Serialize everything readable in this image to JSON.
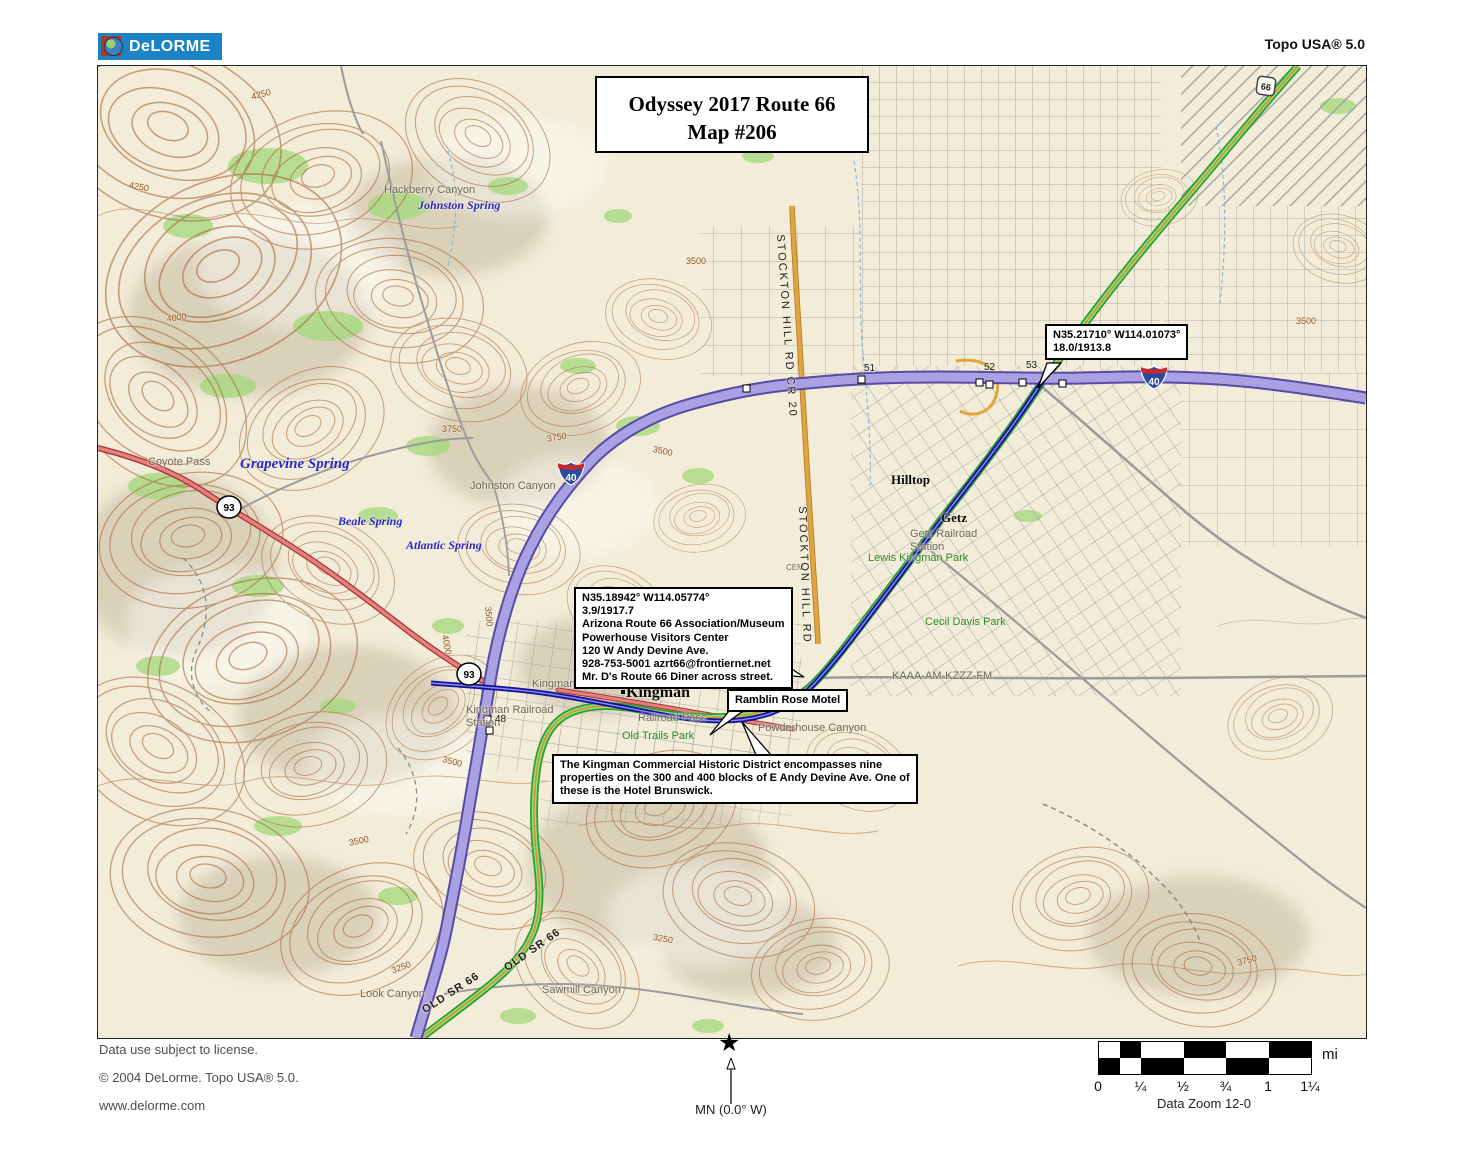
{
  "header": {
    "logo": "DeLORME",
    "product": "Topo USA® 5.0"
  },
  "map": {
    "title_box": {
      "line1": "Odyssey 2017 Route 66",
      "line2": "Map #206"
    },
    "callouts": {
      "waypoint": "N35.21710° W114.01073°\n18.0/1913.8",
      "powerhouse": "N35.18942° W114.05774°\n3.9/1917.7\nArizona Route 66 Association/Museum\nPowerhouse Visitors Center\n120 W Andy Devine Ave.\n928-753-5001 azrt66@frontiernet.net\nMr. D's Route 66 Diner across street.",
      "motel": "Ramblin Rose Motel",
      "historic": "The Kingman Commercial Historic District encompasses nine properties on the 300 and 400 blocks of E Andy Devine Ave. One of these is the Hotel Brunswick."
    },
    "shields": {
      "interstate_40": "40",
      "us_93": "93",
      "historic_66": "66"
    },
    "labels": [
      {
        "text": "Hackberry Canyon",
        "x": 286,
        "y": 118,
        "cls": "terr"
      },
      {
        "text": "Johnston Spring",
        "x": 320,
        "y": 132,
        "cls": "spring"
      },
      {
        "text": "Coyote Pass",
        "x": 50,
        "y": 390,
        "cls": "terr"
      },
      {
        "text": "Grapevine Spring",
        "x": 142,
        "y": 390,
        "cls": "spring big"
      },
      {
        "text": "Beale Spring",
        "x": 240,
        "y": 448,
        "cls": "spring"
      },
      {
        "text": "Atlantic Spring",
        "x": 308,
        "y": 472,
        "cls": "spring"
      },
      {
        "text": "Johnston Canyon",
        "x": 372,
        "y": 414,
        "cls": "terr"
      },
      {
        "text": "Hilltop",
        "x": 793,
        "y": 406,
        "cls": "city"
      },
      {
        "text": "Getz",
        "x": 843,
        "y": 444,
        "cls": "city"
      },
      {
        "text": "Getz Railroad\nStation",
        "x": 812,
        "y": 462,
        "cls": "terr"
      },
      {
        "text": "Lewis Kingman Park",
        "x": 770,
        "y": 486,
        "cls": "park"
      },
      {
        "text": "Cecil Davis Park",
        "x": 827,
        "y": 550,
        "cls": "park"
      },
      {
        "text": "KAAA-AM-KZZZ-FM",
        "x": 794,
        "y": 604,
        "cls": "terr"
      },
      {
        "text": "Kingman",
        "x": 528,
        "y": 618,
        "cls": "city big"
      },
      {
        "text": "Kingman City Hall",
        "x": 434,
        "y": 612,
        "cls": "terr"
      },
      {
        "text": "Kingman Railroad\nStation",
        "x": 368,
        "y": 638,
        "cls": "terr"
      },
      {
        "text": "Railroad Pass",
        "x": 540,
        "y": 646,
        "cls": "terr"
      },
      {
        "text": "Old Trails Park",
        "x": 524,
        "y": 664,
        "cls": "park"
      },
      {
        "text": "Powderhouse Canyon",
        "x": 660,
        "y": 656,
        "cls": "terr"
      },
      {
        "text": "Sawmill Canyon",
        "x": 444,
        "y": 918,
        "cls": "terr"
      },
      {
        "text": "Look Canyon",
        "x": 262,
        "y": 922,
        "cls": "terr"
      },
      {
        "text": "CEM",
        "x": 688,
        "y": 497,
        "cls": "terr small"
      },
      {
        "text": "OLD SR 66",
        "x": 322,
        "y": 940,
        "cls": "road",
        "rot": -33
      },
      {
        "text": "OLD SR 66",
        "x": 404,
        "y": 898,
        "cls": "road",
        "rot": -35
      },
      {
        "text": "STOCKTON HILL RD  CR 20",
        "x": 688,
        "y": 168,
        "cls": "roadv",
        "rot": 86
      },
      {
        "text": "STOCKTON HILL RD",
        "x": 710,
        "y": 440,
        "cls": "roadv",
        "rot": 88
      },
      {
        "text": "51",
        "x": 766,
        "y": 297,
        "cls": "exit"
      },
      {
        "text": "52",
        "x": 886,
        "y": 296,
        "cls": "exit"
      },
      {
        "text": "53",
        "x": 928,
        "y": 294,
        "cls": "exit"
      },
      {
        "text": "48",
        "x": 397,
        "y": 648,
        "cls": "exit"
      },
      {
        "text": "4250",
        "x": 152,
        "y": 26,
        "cls": "elev",
        "rot": -15
      },
      {
        "text": "4250",
        "x": 32,
        "y": 114,
        "cls": "elev",
        "rot": 10
      },
      {
        "text": "4000",
        "x": 68,
        "y": 248,
        "cls": "elev",
        "rot": -8
      },
      {
        "text": "4000",
        "x": 352,
        "y": 568,
        "cls": "elev",
        "rot": 80
      },
      {
        "text": "3750",
        "x": 344,
        "y": 358,
        "cls": "elev"
      },
      {
        "text": "3750",
        "x": 448,
        "y": 368,
        "cls": "elev",
        "rot": -10
      },
      {
        "text": "3500",
        "x": 588,
        "y": 190,
        "cls": "elev"
      },
      {
        "text": "3500",
        "x": 556,
        "y": 378,
        "cls": "elev",
        "rot": 12
      },
      {
        "text": "3500",
        "x": 1198,
        "y": 250,
        "cls": "elev"
      },
      {
        "text": "3500",
        "x": 592,
        "y": 610,
        "cls": "elev",
        "rot": -8
      },
      {
        "text": "3500",
        "x": 346,
        "y": 688,
        "cls": "elev",
        "rot": 15
      },
      {
        "text": "3500",
        "x": 250,
        "y": 772,
        "cls": "elev",
        "rot": -12
      },
      {
        "text": "3250",
        "x": 556,
        "y": 866,
        "cls": "elev",
        "rot": 10
      },
      {
        "text": "3250",
        "x": 292,
        "y": 900,
        "cls": "elev",
        "rot": -20
      },
      {
        "text": "3750",
        "x": 1138,
        "y": 892,
        "cls": "elev",
        "rot": -15
      },
      {
        "text": "3500",
        "x": 395,
        "y": 540,
        "cls": "elev",
        "rot": 85
      }
    ]
  },
  "footer": {
    "license": "Data use subject to license.",
    "copyright": "© 2004 DeLorme. Topo USA® 5.0.",
    "website": "www.delorme.com",
    "north_label": "MN (0.0° W)",
    "scale": {
      "unit": "mi",
      "ticks": [
        "0",
        "¼",
        "½",
        "¾",
        "1",
        "1¼"
      ],
      "datazoom": "Data Zoom 12-0"
    }
  },
  "colors": {
    "map_bg": "#f2ecd8",
    "interstate_fill": "#aaa0e4",
    "interstate_edge": "#574ba2",
    "us_highway": "#e38080",
    "route66_green": "#2f9e2f",
    "historic_gold": "#cf9a22",
    "route_line_blue": "#12129b",
    "minor_road_gray": "#9b9b9b",
    "contour_brown": "#a5673a",
    "vegetation_green": "#a6d97e",
    "logo_blue": "#1b83c6"
  }
}
